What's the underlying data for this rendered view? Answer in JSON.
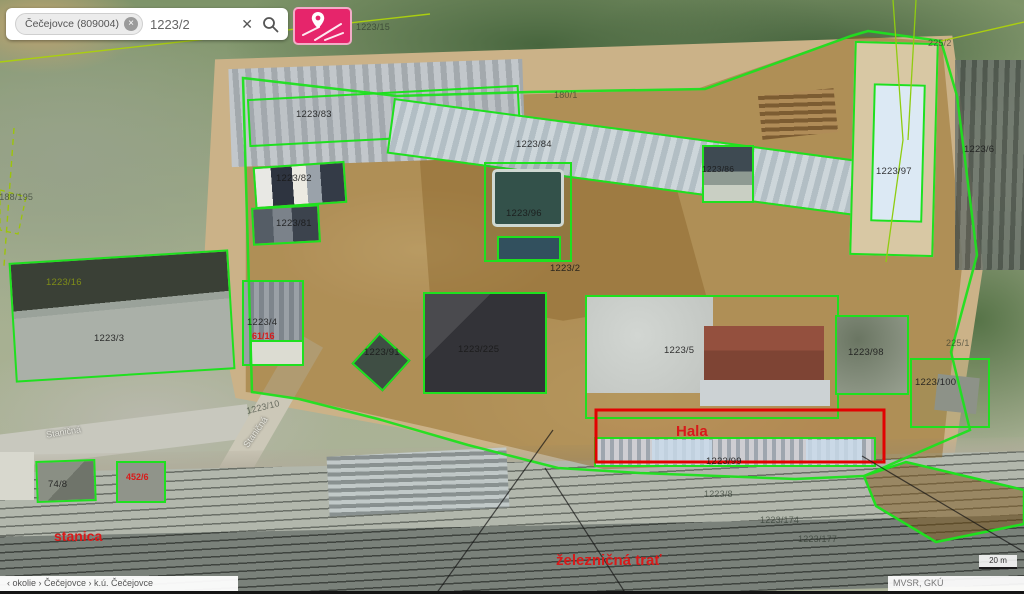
{
  "search_bar": {
    "chip_label": "Čečejovce (809004)",
    "chip_remove": "×",
    "query": "1223/2",
    "clear": "✕"
  },
  "colors": {
    "parcel_outline": "#1fe01f",
    "highlight_outline": "#e20202",
    "accent_pink": "#e6256b",
    "selection_fill": "rgba(143,99,26,0.45)"
  },
  "labels": {
    "p15": "1223/15",
    "p225a": "225/2",
    "p180": "180/1",
    "p2188": "2188/195",
    "p83": "1223/83",
    "p84": "1223/84",
    "p82": "1223/82",
    "p81": "1223/81",
    "p96": "1223/96",
    "p86": "1223/86",
    "p97": "1223/97",
    "p6": "1223/6",
    "p2": "1223/2",
    "p16": "1223/16",
    "p3": "1223/3",
    "p4": "1223/4",
    "h61": "61/16",
    "p91": "1223/91",
    "p225": "1223/225",
    "p5": "1223/5",
    "p98": "1223/98",
    "p100": "1223/100",
    "p225b": "225/1",
    "p10": "1223/10",
    "street1": "Staničná",
    "street2": "Staničná",
    "p74": "74/8",
    "h452": "452/6",
    "stanica": "stanica",
    "hala": "Hala",
    "p99": "1223/99",
    "p8": "1223/8",
    "p174": "1223/174",
    "p177": "1223/177",
    "zeleznicna": "železničná trať"
  },
  "footer": {
    "breadcrumb": "‹ okolie › Čečejovce › k.ú. Čečejovce",
    "attribution": "MVSR, GKÚ",
    "scale": "20 m"
  }
}
